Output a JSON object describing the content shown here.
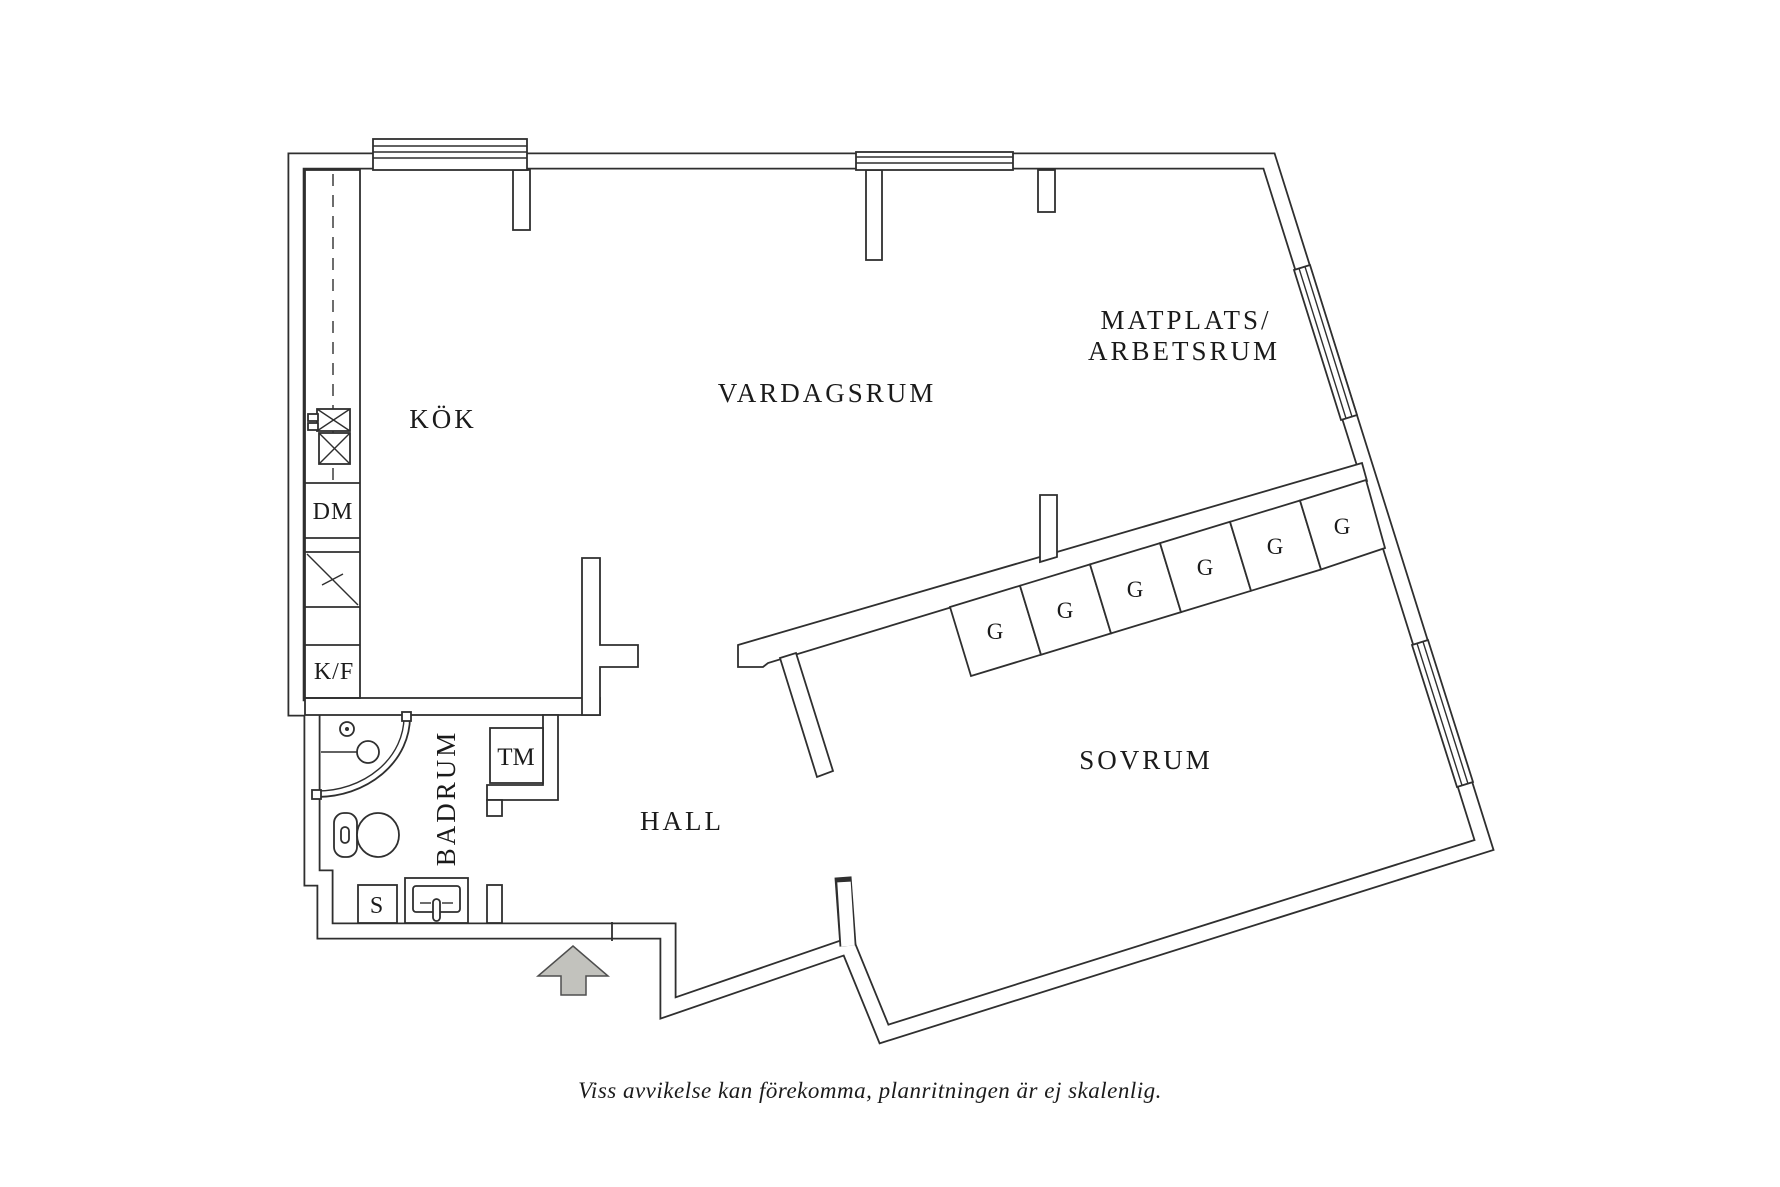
{
  "floor_plan": {
    "rooms": {
      "kitchen": "KÖK",
      "living_room": "VARDAGSRUM",
      "dining_work_line1": "MATPLATS/",
      "dining_work_line2": "ARBETSRUM",
      "bedroom": "SOVRUM",
      "hall": "HALL",
      "bathroom": "BADRUM"
    },
    "appliances": {
      "dishwasher": "DM",
      "fridge_freezer": "K/F",
      "washing_machine": "TM",
      "utility_s": "S"
    },
    "wardrobes": [
      "G",
      "G",
      "G",
      "G",
      "G",
      "G"
    ],
    "icons": {
      "entrance": "arrow-up"
    },
    "footer": "Viss avvikelse kan förekomma, planritningen är ej skalenlig.",
    "colors": {
      "line": "#2f2f2f",
      "text": "#1b1b1b",
      "arrow_fill": "#c2c2bd",
      "background": "#ffffff"
    }
  }
}
